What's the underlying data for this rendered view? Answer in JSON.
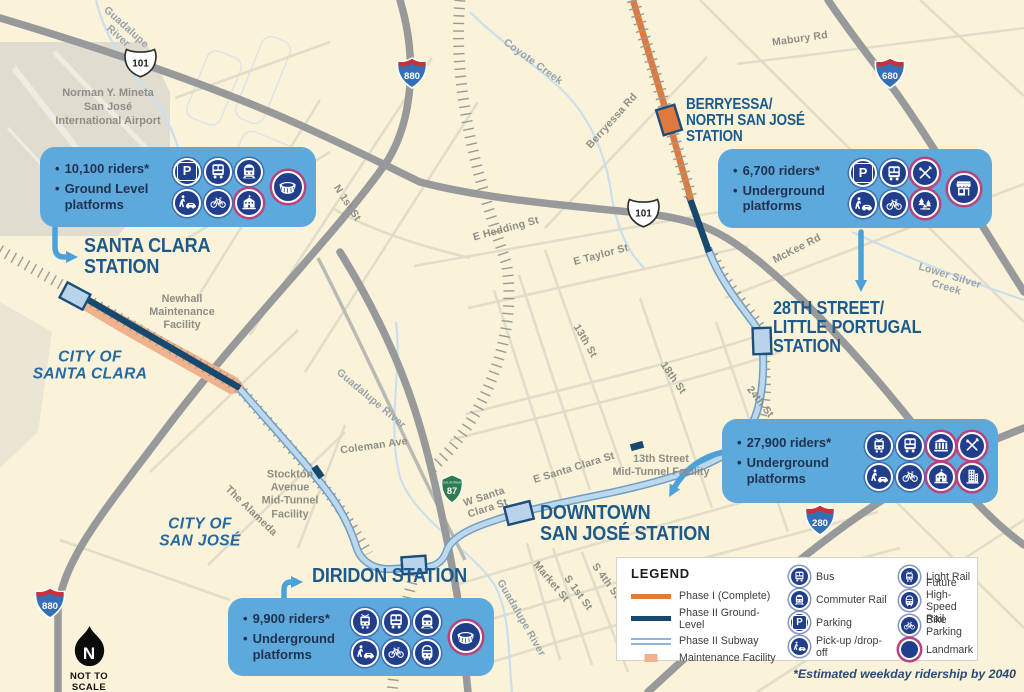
{
  "colors": {
    "background": "#faf3da",
    "phase1": "#e0793d",
    "phase2_ground": "#17496e",
    "phase2_subway": "#bdd8ec",
    "callout": "#5ea9dc",
    "icon_navy": "#203e8c",
    "landmark_ring": "#b5437f",
    "station_text": "#1c5a8c",
    "arrow": "#4ba1d8"
  },
  "stations": [
    {
      "id": "santa-clara",
      "name_lines": [
        "SANTA CLARA",
        "STATION"
      ],
      "label_x": 84,
      "label_y": 236,
      "font": 20.5
    },
    {
      "id": "diridon",
      "name_lines": [
        "DIRIDON STATION"
      ],
      "label_x": 312,
      "label_y": 566,
      "font": 20.5
    },
    {
      "id": "downtown-san-jose",
      "name_lines": [
        "DOWNTOWN",
        "SAN JOSÉ STATION"
      ],
      "label_x": 540,
      "label_y": 503,
      "font": 20.5
    },
    {
      "id": "28th-street-little-portugal",
      "name_lines": [
        "28TH STREET/",
        "LITTLE PORTUGAL",
        "STATION"
      ],
      "label_x": 773,
      "label_y": 299,
      "font": 18.5
    },
    {
      "id": "berryessa-north-san-jose",
      "name_lines": [
        "BERRYESSA/",
        "NORTH SAN JOSÉ",
        "STATION"
      ],
      "label_x": 686,
      "label_y": 97,
      "font": 15.5
    }
  ],
  "callouts": [
    {
      "id": "santa-clara",
      "x": 40,
      "y": 147,
      "w": 276,
      "h": 80,
      "bullets": [
        "10,100 riders*",
        "Ground Level platforms"
      ],
      "icon_rows": [
        [
          {
            "icon": "parking"
          },
          {
            "icon": "bus"
          },
          {
            "icon": "commuter-rail"
          }
        ],
        [
          {
            "icon": "pickup-dropoff"
          },
          {
            "icon": "bike-parking"
          },
          {
            "icon": "school",
            "landmark": true
          }
        ]
      ],
      "extra_icon": {
        "icon": "stadium",
        "landmark": true
      }
    },
    {
      "id": "28th-street-little-portugal",
      "x": 718,
      "y": 149,
      "w": 274,
      "h": 79,
      "bullets": [
        "6,700 riders*",
        "Underground platforms"
      ],
      "icon_rows": [
        [
          {
            "icon": "parking"
          },
          {
            "icon": "bus"
          },
          {
            "icon": "dining",
            "landmark": true
          }
        ],
        [
          {
            "icon": "pickup-dropoff"
          },
          {
            "icon": "bike-parking"
          },
          {
            "icon": "parks",
            "landmark": true
          }
        ]
      ],
      "extra_icon": {
        "icon": "storefront",
        "landmark": true
      }
    },
    {
      "id": "downtown-san-jose",
      "x": 722,
      "y": 419,
      "w": 276,
      "h": 84,
      "bullets": [
        "27,900 riders*",
        "Underground platforms"
      ],
      "icon_rows": [
        [
          {
            "icon": "light-rail"
          },
          {
            "icon": "bus"
          },
          {
            "icon": "bank",
            "landmark": true
          },
          {
            "icon": "dining",
            "landmark": true
          }
        ],
        [
          {
            "icon": "pickup-dropoff"
          },
          {
            "icon": "bike-parking"
          },
          {
            "icon": "school",
            "landmark": true
          },
          {
            "icon": "tower",
            "landmark": true
          }
        ]
      ],
      "extra_icon": null
    },
    {
      "id": "diridon",
      "x": 228,
      "y": 598,
      "w": 266,
      "h": 78,
      "bullets": [
        "9,900 riders*",
        "Underground platforms"
      ],
      "icon_rows": [
        [
          {
            "icon": "light-rail"
          },
          {
            "icon": "bus"
          },
          {
            "icon": "commuter-rail"
          }
        ],
        [
          {
            "icon": "pickup-dropoff"
          },
          {
            "icon": "bike-parking"
          },
          {
            "icon": "high-speed-rail"
          }
        ]
      ],
      "extra_icon": {
        "icon": "stadium",
        "landmark": true
      }
    }
  ],
  "legend": {
    "title": "LEGEND",
    "line_items": [
      {
        "label": "Phase I (Complete)",
        "swatch": "phase1"
      },
      {
        "label": "Phase II Ground-Level",
        "swatch": "phase2-ground"
      },
      {
        "label": "Phase II Subway",
        "swatch": "phase2-subway"
      },
      {
        "label": "Maintenance Facility",
        "swatch": "maintenance"
      }
    ],
    "icon_columns": [
      [
        {
          "label": "Bus",
          "icon": "bus"
        },
        {
          "label": "Commuter Rail",
          "icon": "commuter-rail"
        },
        {
          "label": "Parking",
          "icon": "parking"
        },
        {
          "label": "Pick-up /drop-off",
          "icon": "pickup-dropoff"
        }
      ],
      [
        {
          "label": "Light Rail",
          "icon": "light-rail"
        },
        {
          "label": "Future High-Speed Rail",
          "icon": "high-speed-rail"
        },
        {
          "label": "Bike Parking",
          "icon": "bike-parking"
        },
        {
          "label": "Landmark",
          "icon": "landmark",
          "landmark": true
        }
      ]
    ]
  },
  "map_labels": [
    {
      "text": "Norman Y. Mineta\nSan José\nInternational Airport",
      "x": 108,
      "y": 107,
      "rot": 0,
      "cls": "airport",
      "name": "airport-label"
    },
    {
      "text": "CITY OF\nSANTA CLARA",
      "x": 90,
      "y": 366,
      "rot": 0,
      "cls": "city",
      "name": "city-label-santa-clara"
    },
    {
      "text": "CITY OF\nSAN JOSÉ",
      "x": 200,
      "y": 533,
      "rot": 0,
      "cls": "city",
      "name": "city-label-san-jose"
    },
    {
      "text": "Newhall\nMaintenance\nFacility",
      "x": 182,
      "y": 313,
      "rot": 0,
      "cls": "facility",
      "name": "facility-label-newhall"
    },
    {
      "text": "Stockton\nAvenue\nMid-Tunnel\nFacility",
      "x": 290,
      "y": 495,
      "rot": 0,
      "cls": "facility",
      "name": "facility-label-stockton"
    },
    {
      "text": "13th Street\nMid-Tunnel Facility",
      "x": 661,
      "y": 466,
      "rot": 0,
      "cls": "facility",
      "name": "facility-label-13th-street"
    },
    {
      "text": "Guadalupe\nRiver",
      "x": 122,
      "y": 32,
      "rot": 42,
      "cls": "river"
    },
    {
      "text": "Coyote Creek",
      "x": 533,
      "y": 62,
      "rot": 36,
      "cls": "river"
    },
    {
      "text": "Lower Silver Creek",
      "x": 948,
      "y": 282,
      "rot": 17,
      "cls": "river"
    },
    {
      "text": "Guadalupe River",
      "x": 371,
      "y": 399,
      "rot": 40,
      "cls": "river"
    },
    {
      "text": "Guadalupe River",
      "x": 521,
      "y": 618,
      "rot": 60,
      "cls": "river"
    },
    {
      "text": "N 1st St",
      "x": 347,
      "y": 203,
      "rot": 57,
      "cls": "street"
    },
    {
      "text": "E Hedding St",
      "x": 506,
      "y": 229,
      "rot": -15,
      "cls": "street"
    },
    {
      "text": "E Taylor St",
      "x": 601,
      "y": 255,
      "rot": -15,
      "cls": "street"
    },
    {
      "text": "Berryessa Rd",
      "x": 612,
      "y": 121,
      "rot": -48,
      "cls": "street"
    },
    {
      "text": "Mabury Rd",
      "x": 800,
      "y": 39,
      "rot": -8,
      "cls": "street"
    },
    {
      "text": "McKee Rd",
      "x": 797,
      "y": 249,
      "rot": -27,
      "cls": "street"
    },
    {
      "text": "13th St",
      "x": 585,
      "y": 341,
      "rot": 60,
      "cls": "street"
    },
    {
      "text": "18th St",
      "x": 673,
      "y": 378,
      "rot": 55,
      "cls": "street"
    },
    {
      "text": "24th St",
      "x": 760,
      "y": 402,
      "rot": 52,
      "cls": "street"
    },
    {
      "text": "E Santa Clara St",
      "x": 574,
      "y": 468,
      "rot": -17,
      "cls": "street"
    },
    {
      "text": "W Santa\nClara St",
      "x": 486,
      "y": 503,
      "rot": -18,
      "cls": "street"
    },
    {
      "text": "Market St",
      "x": 551,
      "y": 582,
      "rot": 50,
      "cls": "street"
    },
    {
      "text": "S 1st St",
      "x": 578,
      "y": 593,
      "rot": 54,
      "cls": "street"
    },
    {
      "text": "S 4th St",
      "x": 606,
      "y": 581,
      "rot": 54,
      "cls": "street"
    },
    {
      "text": "Coleman Ave",
      "x": 374,
      "y": 446,
      "rot": -8,
      "cls": "street"
    },
    {
      "text": "The Alameda",
      "x": 251,
      "y": 511,
      "rot": 44,
      "cls": "street"
    }
  ],
  "shields": [
    {
      "route": "US",
      "num": "101",
      "x": 124,
      "y": 44,
      "s": 33
    },
    {
      "route": "I",
      "num": "880",
      "x": 396,
      "y": 56,
      "s": 32
    },
    {
      "route": "I",
      "num": "680",
      "x": 874,
      "y": 56,
      "s": 32
    },
    {
      "route": "US",
      "num": "101",
      "x": 627,
      "y": 194,
      "s": 33
    },
    {
      "route": "CA",
      "num": "87",
      "x": 438,
      "y": 474,
      "s": 28
    },
    {
      "route": "I",
      "num": "280",
      "x": 804,
      "y": 503,
      "s": 32
    },
    {
      "route": "I",
      "num": "880",
      "x": 34,
      "y": 586,
      "s": 32
    }
  ],
  "compass": {
    "letter": "N",
    "caption": "NOT TO SCALE"
  },
  "footnote": "*Estimated weekday ridership by 2040"
}
